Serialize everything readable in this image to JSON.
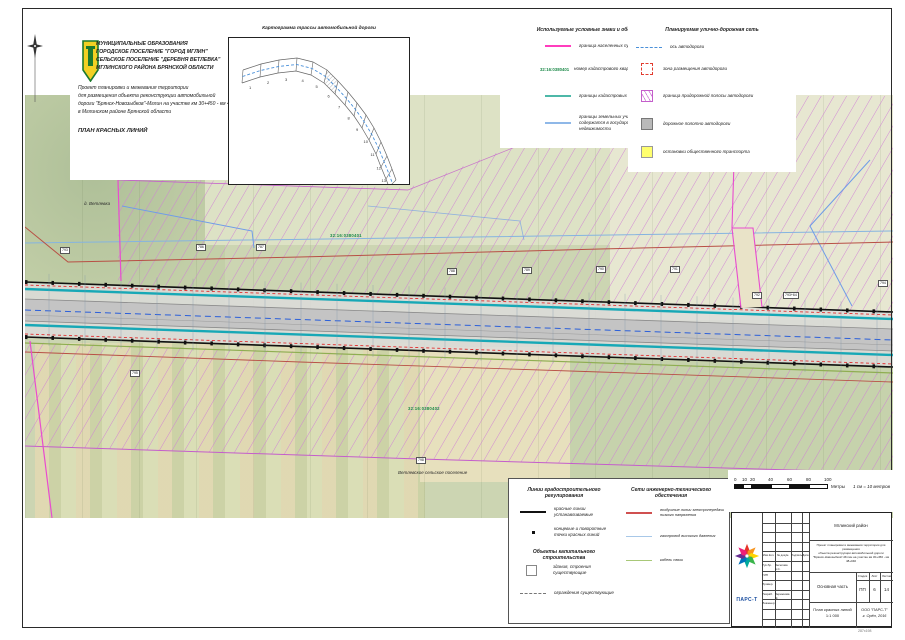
{
  "sheet": {
    "size_note": "287x198"
  },
  "colors": {
    "magenta_boundary": "#e84ccf",
    "teal_quarter": "#2aa9b4",
    "lightblue_parcel": "#8ab6e4",
    "blue_axis": "#2b5fd9",
    "red_power": "#c05545",
    "green_cable": "#8fae52",
    "hatch_violet": "#cf7fd6",
    "red_zone": "#e23b2e",
    "yellow_stop": "#ffff6e",
    "gray_road": "#c4c4c4",
    "green_number": "#1e8a4a",
    "logo_blue": "#1b4fa0"
  },
  "header": {
    "org_lines": [
      "МУНИЦИПАЛЬНЫЕ ОБРАЗОВАНИЯ",
      "ГОРОДСКОЕ ПОСЕЛЕНИЕ \"ГОРОД МГЛИН\"",
      "СЕЛЬСКОЕ ПОСЕЛЕНИЕ \"ДЕРЕВНЯ ВЕТЛЕВКА\"",
      "МГЛИНСКОГО РАЙОНА БРЯНСКОЙ ОБЛАСТИ"
    ],
    "project_lines": [
      "Проект планировки и межевания территории",
      "для размещения объекта реконструкции автомобильной",
      "дороги \"Брянск-Новозыбков\"-Мглин на участке км 30+450 - км 48+040",
      "в Мглинском районе Брянской области"
    ],
    "plan_title": "ПЛАН КРАСНЫХ ЛИНИЙ"
  },
  "inset": {
    "title": "Картограмма трассы автомобильной дороги",
    "segment_numbers": [
      "1",
      "2",
      "3",
      "4",
      "5",
      "6",
      "7",
      "8",
      "9",
      "10",
      "11",
      "12",
      "13",
      "14"
    ]
  },
  "legend_symbols": {
    "title": "Используемые условные знаки и обозначения",
    "items": [
      {
        "label": "граница населенных пунктов"
      },
      {
        "swatch_text": "32:16:0380401",
        "label": "номер кадастрового квартала"
      },
      {
        "label": "границы кадастровых кварталов"
      },
      {
        "label": "границы земельных участков, сведения о которых содержатся в государственном кадастре недвижимости"
      }
    ]
  },
  "legend_network": {
    "title": "Планируемая улично-дорожная сеть",
    "items": [
      {
        "label": "ось автодороги"
      },
      {
        "label": "зона размещения автодороги"
      },
      {
        "label": "граница придорожной полосы автодороги"
      },
      {
        "label": "дорожное полотно автодороги"
      },
      {
        "label": "остановки общественного транспорта"
      }
    ]
  },
  "legend_reg": {
    "title": "Линии градостроительного регулирования",
    "items": [
      {
        "label": "красные линии устанавливаемые"
      },
      {
        "label": "концевые и поворотные точки красных линий"
      }
    ]
  },
  "legend_capital": {
    "title": "Объекты капитального строительства",
    "items": [
      {
        "label": "здания, строения существующие"
      },
      {
        "label": "ограждения существующие"
      }
    ]
  },
  "legend_eng": {
    "title": "Сети инженерно-технического обеспечения",
    "items": [
      {
        "label": "воздушные линии электропередачи низкого напряжения"
      },
      {
        "label": "газопровод высокого давления"
      },
      {
        "label": "кабель связи"
      }
    ]
  },
  "scalebar": {
    "ticks": [
      "0",
      "10",
      "20",
      "40",
      "60",
      "80",
      "100"
    ],
    "units": "Метры",
    "note": "1 см = 10 метров"
  },
  "map": {
    "village": "д. Ветлевка",
    "settlement": "Ветлевское сельское поселение",
    "quarter_top": "32:16:0380401",
    "quarter_bottom": "32:16:0380402",
    "parcel_tags": [
      {
        "x": 60,
        "y": 247,
        "t": "793"
      },
      {
        "x": 196,
        "y": 244,
        "t": "786"
      },
      {
        "x": 256,
        "y": 244,
        "t": "787"
      },
      {
        "x": 447,
        "y": 268,
        "t": "788"
      },
      {
        "x": 522,
        "y": 267,
        "t": "789"
      },
      {
        "x": 596,
        "y": 266,
        "t": "790"
      },
      {
        "x": 670,
        "y": 266,
        "t": "791"
      },
      {
        "x": 752,
        "y": 292,
        "t": "792"
      },
      {
        "x": 783,
        "y": 292,
        "t": "793+64"
      },
      {
        "x": 878,
        "y": 280,
        "t": "794"
      },
      {
        "x": 130,
        "y": 370,
        "t": "795"
      },
      {
        "x": 416,
        "y": 457,
        "t": "798"
      }
    ]
  },
  "titleblock": {
    "district": "Мглинский район",
    "project_desc": [
      "Проект планировки и межевания территории для размещения",
      "объекта реконструкции автомобильной дороги",
      "\"Брянск-Новозыбков\"-Мглин на участке км 30+450 - км 48+040"
    ],
    "part": "Основная часть",
    "stage_label": "Стадия",
    "sheet_label": "Лист",
    "sheets_label": "Листов",
    "stage": "ПП",
    "sheet": "6",
    "sheets": "14",
    "doc": "План красных линий",
    "scale": "1:1 000",
    "company": "ООО \"ПАРС-Т\"",
    "place": "г. Орёл, 2016",
    "logo": "ПАРС-Т",
    "sig_headers": [
      "Изм.Кол.",
      "№ докум.",
      "Подпись",
      "Дата"
    ],
    "sig_rows": [
      {
        "role": "Рук.бр.",
        "name": "Веселова Е.С."
      },
      {
        "role": "ГИП",
        "name": ""
      },
      {
        "role": "Провер.",
        "name": ""
      },
      {
        "role": "Разраб.",
        "name": "Вережнова М."
      },
      {
        "role": "Инженер",
        "name": ""
      }
    ]
  }
}
